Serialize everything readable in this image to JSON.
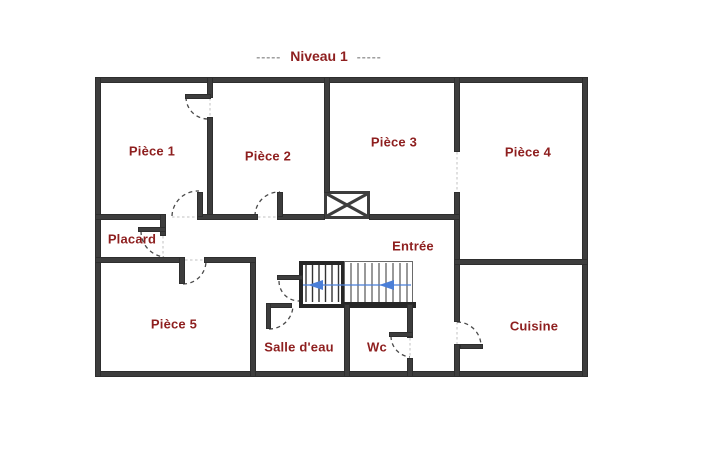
{
  "title": {
    "dashes_left": "-----",
    "text": "Niveau 1",
    "dashes_right": "-----"
  },
  "rooms": [
    {
      "id": "piece-1",
      "name": "Pièce 1"
    },
    {
      "id": "piece-2",
      "name": "Pièce 2"
    },
    {
      "id": "piece-3",
      "name": "Pièce 3"
    },
    {
      "id": "piece-4",
      "name": "Pièce 4"
    },
    {
      "id": "placard",
      "name": "Placard"
    },
    {
      "id": "entree",
      "name": "Entrée"
    },
    {
      "id": "piece-5",
      "name": "Pièce 5"
    },
    {
      "id": "salle-deau",
      "name": "Salle d'eau"
    },
    {
      "id": "wc",
      "name": "Wc"
    },
    {
      "id": "cuisine",
      "name": "Cuisine"
    }
  ],
  "stair": {
    "direction_arrow_count": 2,
    "direction": "left"
  },
  "colors": {
    "room_label": "#8e1f1f",
    "wall": "#3d3d3d",
    "stair_dark": "#262626",
    "stair_arrow_blue": "#4b7fd8",
    "title_dashes": "#9a9a9a"
  }
}
